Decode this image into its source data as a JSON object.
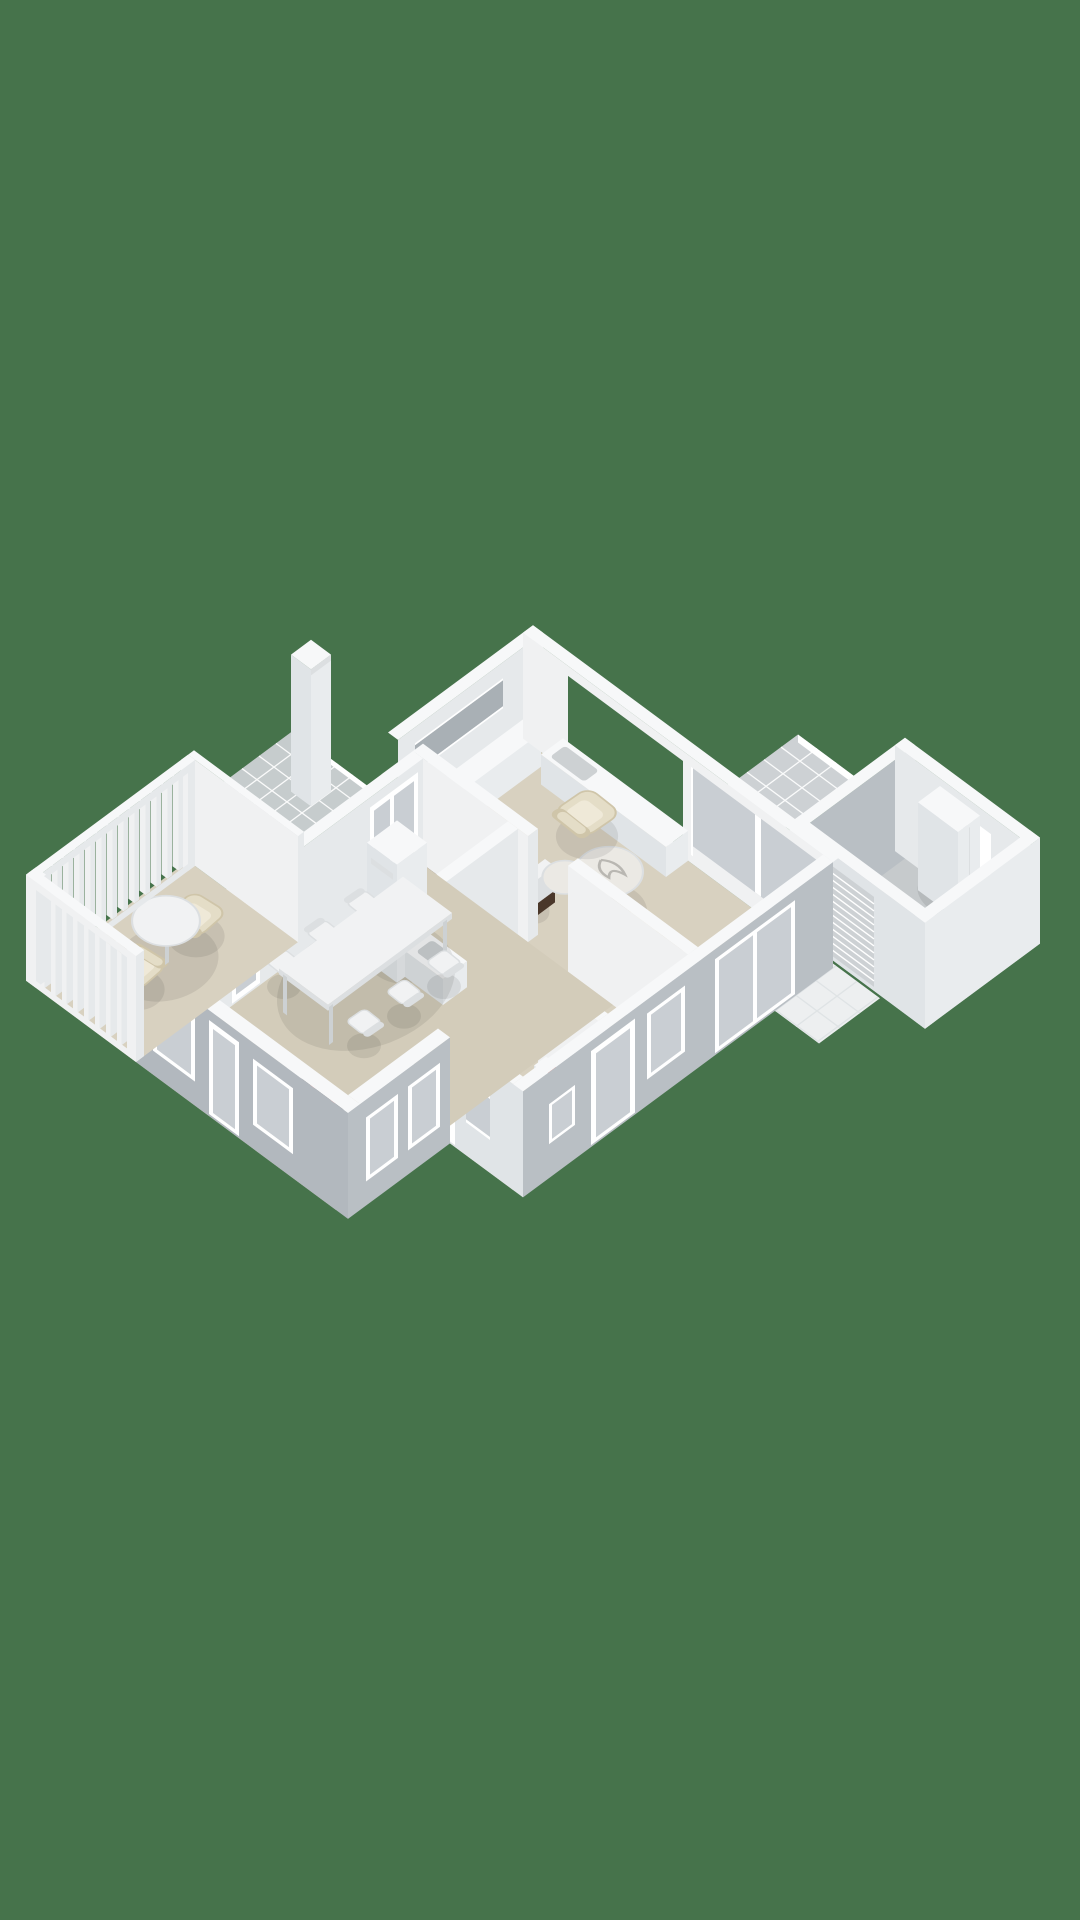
{
  "meta": {
    "view": "isometric-3d-floorplan-render",
    "level": "ground-floor",
    "visible_text": ""
  },
  "colors": {
    "background": "#46734b",
    "floor": "#d8d1c0",
    "floorKitchen": "#d3ccba",
    "grayFloor": "#c6cacc",
    "rug": "#d2c8b2",
    "rugLine": "#bcb098",
    "wallTop": "#f7f8f9",
    "wallInnerU": "#e6e9eb",
    "wallInnerV": "#f0f1f2",
    "wallGrayU": "#b9bfc4",
    "wallGrayV": "#b2b8be",
    "wallWhiteU": "#e9ecee",
    "wallWhiteV": "#e0e4e7",
    "glass": "#c9ced3",
    "glassDark": "#a9b0b5",
    "frame": "#ffffff",
    "tile": "#cdd1d4",
    "tileLine": "#ffffff",
    "apron": "#edeff0",
    "apronLine": "#dde1e3",
    "furnWhite": "#f1f2f3",
    "furnShade": "#dcdfe1",
    "legGray": "#cdd1d3",
    "cream": "#e4ddc7",
    "creamDark": "#cfc5a9",
    "creamLight": "#efe9d8",
    "wood": "#5e4737",
    "woodDark": "#4a372a",
    "marble": "#ebe9e4",
    "marbleVein": "#b9b7b2",
    "cooktop": "#191a1c",
    "burner": "#ce2a1f",
    "burnerDark": "#7e150f",
    "fireBox": "#241611",
    "fire": "#e2761d",
    "flame": "#f3b43c",
    "metal": "#9aa0a5",
    "shadow": "rgba(0,0,0,0.08)"
  },
  "scene": {
    "building": "single-storey-house-3d-floorplan",
    "rooms": [
      {
        "name": "living-room",
        "floor": "beige",
        "items": [
          "sofa",
          "armchair",
          "lounge-chair",
          "coffee-table-large",
          "coffee-table-small",
          "window-bench",
          "media-cabinet",
          "desk"
        ]
      },
      {
        "name": "dining-room",
        "floor": "beige",
        "items": [
          "dining-table",
          "six-chairs",
          "wood-stove-fireplace"
        ]
      },
      {
        "name": "kitchen",
        "floor": "beige",
        "items": [
          "l-counter",
          "cooktop-4-red-burners",
          "sink"
        ]
      },
      {
        "name": "hallway",
        "floor": "beige",
        "items": [
          "side-table",
          "chair",
          "console-niche-red-books"
        ]
      },
      {
        "name": "entry",
        "floor": "beige",
        "items": [
          "rug",
          "front-door",
          "small-window"
        ]
      },
      {
        "name": "bathroom",
        "floor": "gray",
        "items": [
          "toilet"
        ]
      },
      {
        "name": "veranda",
        "floor": "beige",
        "items": [
          "round-table",
          "two-armchairs",
          "slatted-glass-walls"
        ]
      },
      {
        "name": "garage",
        "floor": "gray",
        "items": [
          "wardrobe-cabinet",
          "ribbed-garage-door",
          "double-doors",
          "tile-apron"
        ]
      },
      {
        "name": "exterior",
        "floor": "none",
        "items": [
          "chimney",
          "glass-tile-roof",
          "tiled-terrace-roof"
        ]
      }
    ]
  }
}
